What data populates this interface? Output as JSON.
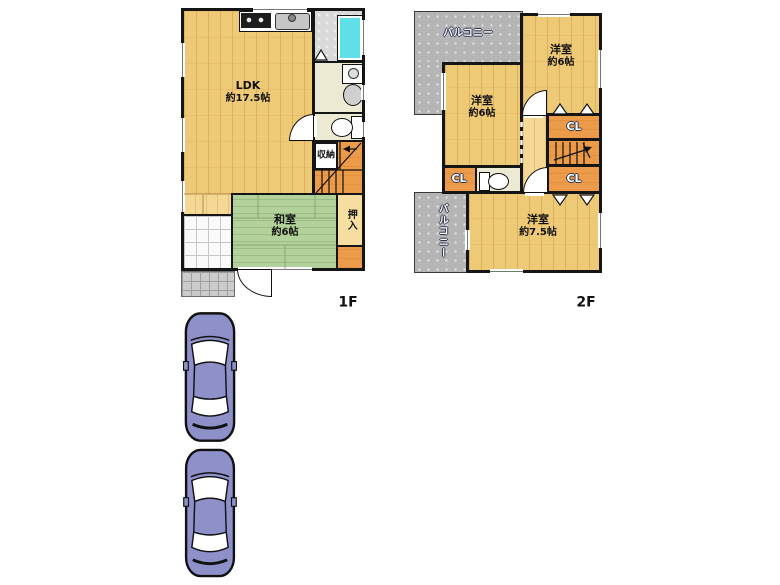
{
  "floor1": {
    "label": "1F",
    "ldk": {
      "name": "LDK",
      "size": "約17.5帖"
    },
    "washitsu": {
      "name": "和室",
      "size": "約6帖"
    },
    "oshiire": "押入",
    "storage": "収納"
  },
  "floor2": {
    "label": "2F",
    "bedroom_ne": {
      "name": "洋室",
      "size": "約6帖"
    },
    "bedroom_w": {
      "name": "洋室",
      "size": "約6帖"
    },
    "bedroom_s": {
      "name": "洋室",
      "size": "約7.5帖"
    },
    "closet_top": "CL",
    "closet_bottom": "CL",
    "closet_left": "CL",
    "balcony_top": "バルコニー",
    "balcony_bottom": "バルコニー"
  },
  "colors": {
    "wood_floor": "#eec976",
    "hall_floor": "#f4d894",
    "tatami_green": "#b3d29b",
    "closet_orange": "#eb9b49",
    "balcony_gray": "#b5b5b5",
    "bathtub_cyan": "#5fe0e8",
    "car_body": "#8e90ca"
  }
}
